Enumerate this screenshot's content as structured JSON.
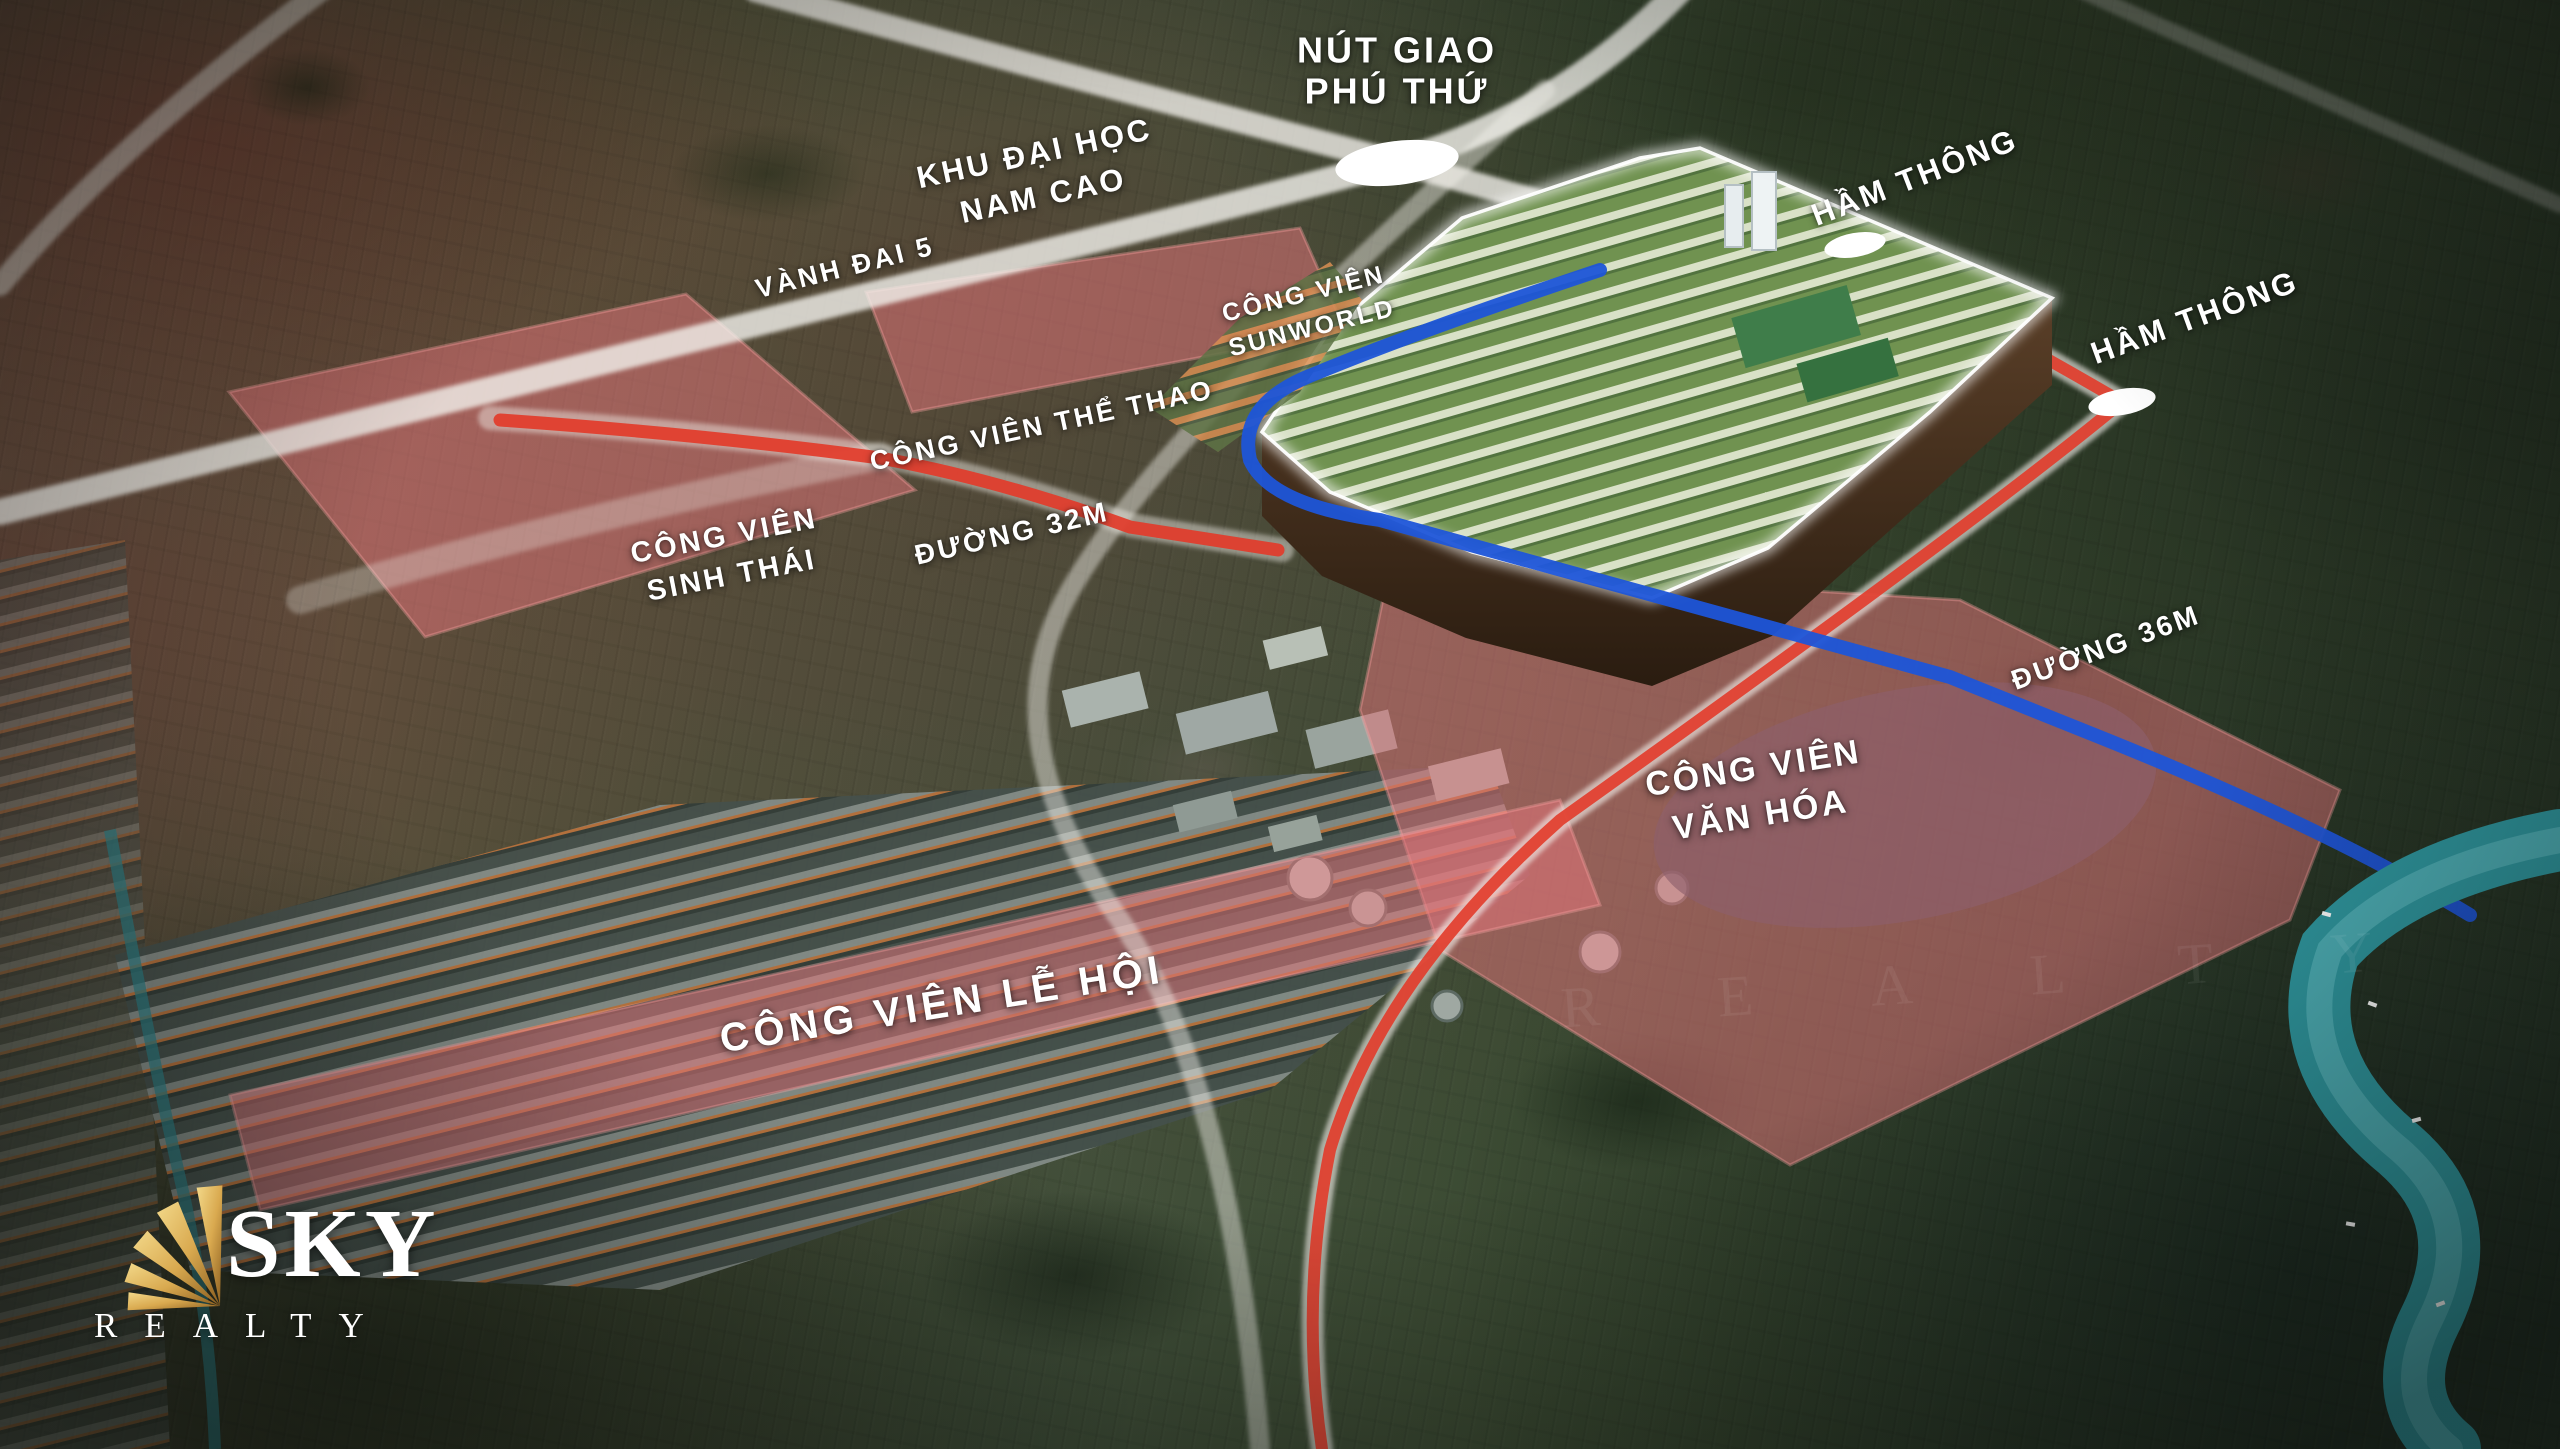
{
  "brand": {
    "name": "SKY",
    "tagline": "REALTY"
  },
  "map_labels": {
    "nut_giao": {
      "line1": "NÚT GIAO",
      "line2": "PHÚ THỨ"
    },
    "khu_dai_hoc": {
      "line1": "KHU ĐẠI HỌC",
      "line2": "NAM CAO"
    },
    "vanh_dai_5": {
      "text": "VÀNH ĐAI 5"
    },
    "ham_thong_1": {
      "text": "HẦM THÔNG"
    },
    "ham_thong_2": {
      "text": "HẦM THÔNG"
    },
    "cv_sunworld": {
      "line1": "CÔNG VIÊN",
      "line2": "SUNWORLD"
    },
    "cv_the_thao": {
      "text": "CÔNG VIÊN THỂ THAO"
    },
    "cv_sinh_thai": {
      "line1": "CÔNG VIÊN",
      "line2": "SINH THÁI"
    },
    "duong_32m": {
      "text": "ĐƯỜNG 32M"
    },
    "cv_van_hoa": {
      "line1": "CÔNG VIÊN",
      "line2": "VĂN HÓA"
    },
    "duong_36m": {
      "text": "ĐƯỜNG 36M"
    },
    "cv_le_hoi": {
      "text": "CÔNG VIÊN LỄ HỘI"
    }
  },
  "colors": {
    "road_highlight_red": "#e23b2a",
    "road_highlight_blue": "#1d55d8",
    "park_overlay_pink": "#e5757a",
    "river_teal": "#2f98a0",
    "logo_gold": "#d9a94f",
    "label_text": "#ffffff"
  }
}
